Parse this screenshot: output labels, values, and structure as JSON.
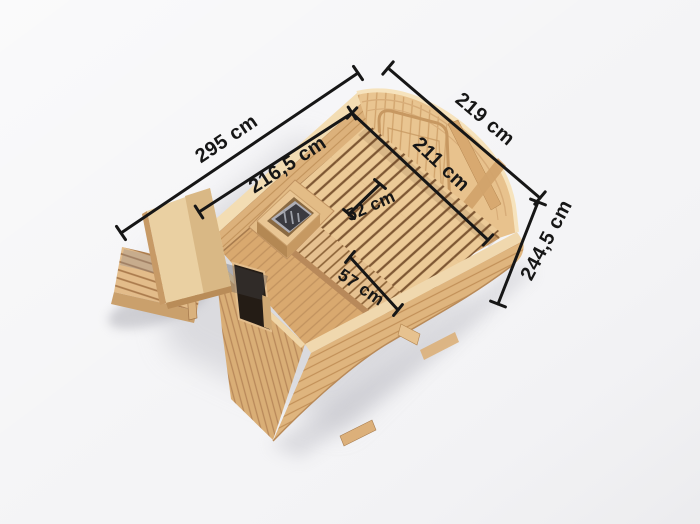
{
  "dimensions": {
    "outer_width": "295 cm",
    "outer_depth": "219 cm",
    "outer_height": "244,5 cm",
    "inner_width": "216,5 cm",
    "inner_depth": "211 cm",
    "bench_upper_depth": "52 cm",
    "bench_lower_depth": "57 cm"
  },
  "colors": {
    "background": "#f4f4f6",
    "dimension_line": "#161616",
    "wood_light": "#f0d8ae",
    "wood_mid": "#e3ba85",
    "wood_dark": "#b98a58",
    "bench_slat_gap": "#7e5733",
    "heater_stones": "#3a3a40",
    "door_dark": "#241c15",
    "shadow": "#c6c6cc"
  }
}
